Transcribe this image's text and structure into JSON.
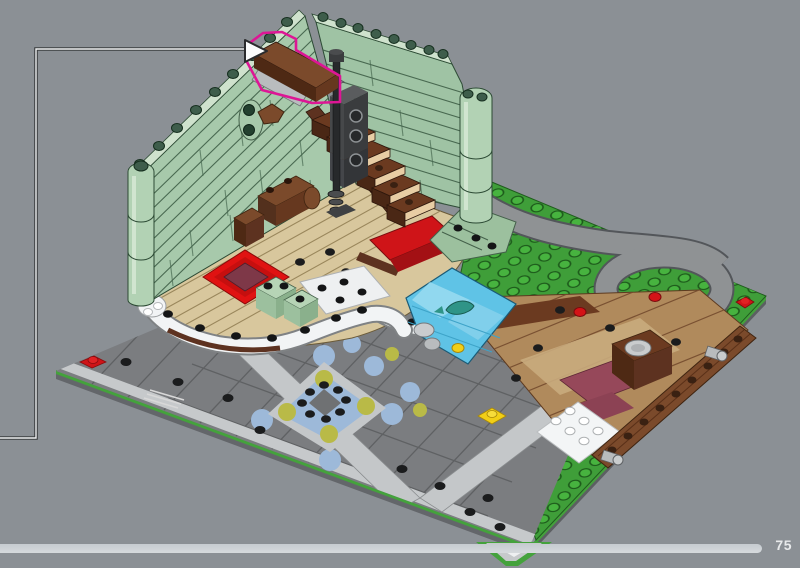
{
  "viewport": {
    "background_color": "#8b9095",
    "kind": "lego-instruction-3d-view"
  },
  "callout": {
    "line_color": "#3b3d3f",
    "line_core_color": "#eef0f1",
    "arrow_icon": "right-arrow",
    "arrow_fill": "#fbfcfc"
  },
  "highlight": {
    "outline_color": "#dd1695",
    "target_part": "reddish-brown-stair-railing"
  },
  "model_palette": {
    "sand_green_wall": "#a7c9ab",
    "bright_green_baseplate": "#3f9e39",
    "street_gray": "#7b7d80",
    "curb_light_gray": "#c4c7c9",
    "parquet_tan": "#d8c79d",
    "carpet_red": "#e01212",
    "carpet_center": "#7e3848",
    "stair_brown": "#6b3a20",
    "deck_wood": "#b08a5c",
    "log_brown": "#7b4a2b",
    "water_blue": "#5fc3e6",
    "maroon_plate": "#96485a",
    "road_gray": "#8f9294",
    "accent_red": "#cf1418",
    "accent_yellow": "#f2cf16"
  },
  "footer": {
    "page_number": "75",
    "bar_color": "#cbd0d4",
    "page_number_color": "#e8eaeb"
  }
}
